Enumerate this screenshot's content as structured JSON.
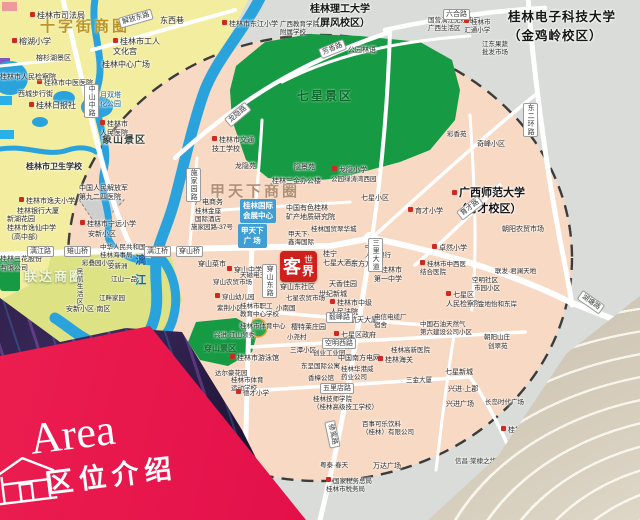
{
  "banner": {
    "title_en": "Area",
    "title_zh": "区位介绍"
  },
  "logo": {
    "c1": "客",
    "c2": "世",
    "c3": "界",
    "name": "客世界"
  },
  "palette": {
    "banner_red": "#e3114a",
    "logo_red": "#d0201c",
    "circle_fill": "#f8d9c3",
    "outside_gray": "#d9dcd8",
    "old_town_yellow": "#f3eda0",
    "park_green": "#169a43",
    "water_blue": "#2aa3dc",
    "road_white": "#ffffff",
    "dash_border": "#3c3c3c"
  },
  "map": {
    "labels": [
      {
        "t": "十字街商圈",
        "x": 40,
        "y": 18,
        "c": "biz1"
      },
      {
        "t": "甲天下商圈",
        "x": 210,
        "y": 183,
        "c": "biz2"
      },
      {
        "t": "联达商圈",
        "x": 24,
        "y": 269,
        "c": "biz3"
      },
      {
        "t": "七星景区",
        "x": 297,
        "y": 89,
        "c": "grn grnb"
      },
      {
        "t": "象山景区",
        "x": 102,
        "y": 135,
        "c": "dkb"
      },
      {
        "t": "穿山景区",
        "x": 204,
        "y": 344,
        "c": "grn"
      },
      {
        "t": "漓江",
        "x": 132,
        "y": 254,
        "c": "wtrv"
      },
      {
        "t": "桂林电子科技大学\n（金鸡岭校区）",
        "x": 508,
        "y": 8,
        "c": "uni"
      },
      {
        "t": "广西师范大学\n（育才校区）",
        "x": 452,
        "y": 186,
        "c": "uni2 cen",
        "ic": true
      },
      {
        "t": "桂林理工大学\n（屏风校区）",
        "x": 310,
        "y": 3,
        "c": "uni3 cen"
      },
      {
        "t": "桂林市司法局",
        "x": 30,
        "y": 11,
        "ic": true
      },
      {
        "t": "东西巷",
        "x": 160,
        "y": 16
      },
      {
        "t": "桂林市工人\n文化宫",
        "x": 113,
        "y": 37,
        "ic": true
      },
      {
        "t": "桂林中心广场",
        "x": 102,
        "y": 60
      },
      {
        "t": "榕湖小学",
        "x": 12,
        "y": 37,
        "ic": true
      },
      {
        "t": "榕杉湖景区",
        "x": 36,
        "y": 55,
        "c": "t7"
      },
      {
        "t": "桂林市中医医院",
        "x": 37,
        "y": 79,
        "c": "t7",
        "ic": true
      },
      {
        "t": "西城步行街",
        "x": 18,
        "y": 91,
        "c": "t7"
      },
      {
        "t": "桂林日报社",
        "x": 29,
        "y": 101,
        "ic": true
      },
      {
        "t": "日月双塔\n文化公园",
        "x": 93,
        "y": 92,
        "c": "wtr t7"
      },
      {
        "t": "桂林市人民检察院",
        "x": 0,
        "y": 74,
        "c": "t7"
      },
      {
        "t": "桂林市\n人民医院",
        "x": 100,
        "y": 120,
        "c": "t7",
        "ic": true
      },
      {
        "t": "桂林市卫生学校",
        "x": 26,
        "y": 162,
        "c": "bold"
      },
      {
        "t": "桂林市逸夫小学",
        "x": 19,
        "y": 197,
        "c": "t7",
        "ic": true
      },
      {
        "t": "桂林银行大厦",
        "x": 17,
        "y": 208,
        "c": "t7"
      },
      {
        "t": "新湖花园",
        "x": 7,
        "y": 216,
        "c": "t7"
      },
      {
        "t": "桂林市逸仙中学\n（高中部）",
        "x": 7,
        "y": 225,
        "c": "t7"
      },
      {
        "t": "桂林三花股份\n有限公司",
        "x": 0,
        "y": 256,
        "c": "t7"
      },
      {
        "t": "中国人民解放军\n第九二四医院",
        "x": 79,
        "y": 185,
        "c": "t7"
      },
      {
        "t": "桂林市宁远小学",
        "x": 80,
        "y": 220,
        "c": "t7",
        "ic": true
      },
      {
        "t": "安新小区",
        "x": 88,
        "y": 231,
        "c": "t7"
      },
      {
        "t": "彩叠园小区",
        "x": 82,
        "y": 260,
        "c": "t65"
      },
      {
        "t": "民航生活区",
        "x": 74,
        "y": 268,
        "c": "t65 vert"
      },
      {
        "t": "安新洲",
        "x": 108,
        "y": 263,
        "c": "t65"
      },
      {
        "t": "江山一品",
        "x": 111,
        "y": 276,
        "c": "t65"
      },
      {
        "t": "江畔家园",
        "x": 99,
        "y": 295,
        "c": "t65"
      },
      {
        "t": "安新小区·南区",
        "x": 66,
        "y": 306,
        "c": "t7"
      },
      {
        "t": "中华人民共和国\n桂林海事局",
        "x": 100,
        "y": 244,
        "c": "t65"
      },
      {
        "t": "漓江路",
        "x": 27,
        "y": 246,
        "c": "rbox"
      },
      {
        "t": "雉山桥",
        "x": 64,
        "y": 246,
        "c": "rbox"
      },
      {
        "t": "漓江桥",
        "x": 144,
        "y": 246,
        "c": "rbox"
      },
      {
        "t": "穿山桥",
        "x": 176,
        "y": 246,
        "c": "rbox"
      },
      {
        "t": "解放东路",
        "x": 118,
        "y": 18,
        "c": "rbox",
        "rot": -16
      },
      {
        "t": "中山中路",
        "x": 84,
        "y": 84,
        "c": "rbox vert"
      },
      {
        "t": "桂林市东江小学",
        "x": 222,
        "y": 20,
        "c": "t7",
        "ic": true
      },
      {
        "t": "广西教育学院\n附属学校",
        "x": 280,
        "y": 21,
        "c": "t65"
      },
      {
        "t": "公园林语",
        "x": 348,
        "y": 47,
        "c": "t7"
      },
      {
        "t": "桂林市交通\n技工学校",
        "x": 212,
        "y": 136,
        "c": "t7",
        "ic": true
      },
      {
        "t": "龙隐苑",
        "x": 235,
        "y": 163,
        "c": "t7"
      },
      {
        "t": "隐景苑",
        "x": 294,
        "y": 164,
        "c": "t7"
      },
      {
        "t": "龙隐小学",
        "x": 332,
        "y": 166,
        "c": "t7",
        "ic": true
      },
      {
        "t": "公园绿涛湾西园",
        "x": 331,
        "y": 176,
        "c": "t65"
      },
      {
        "t": "桂林三金办公楼",
        "x": 272,
        "y": 178,
        "c": "t7"
      },
      {
        "t": "七星小区",
        "x": 361,
        "y": 195,
        "c": "t7"
      },
      {
        "t": "广电商务",
        "x": 195,
        "y": 199,
        "c": "t7"
      },
      {
        "t": "桂林金座\n国际酒店",
        "x": 195,
        "y": 208,
        "c": "t65"
      },
      {
        "t": "施家园路-37号",
        "x": 191,
        "y": 224,
        "c": "t65"
      },
      {
        "t": "中国有色桂林\n矿产地质研究院",
        "x": 286,
        "y": 205,
        "c": "t7"
      },
      {
        "t": "桂林国贸翠华城",
        "x": 311,
        "y": 226,
        "c": "t65"
      },
      {
        "t": "甲天下·\n鑫海国际",
        "x": 288,
        "y": 231,
        "c": "t65"
      },
      {
        "t": "桂宁\n七星大酒店",
        "x": 323,
        "y": 251,
        "c": "t7"
      },
      {
        "t": "中国\n人民银行",
        "x": 365,
        "y": 244,
        "c": "t65"
      },
      {
        "t": "东方方圆",
        "x": 351,
        "y": 261,
        "c": "t7"
      },
      {
        "t": "天香佳园",
        "x": 329,
        "y": 281,
        "c": "t7"
      },
      {
        "t": "世纪新城",
        "x": 319,
        "y": 291,
        "c": "t7"
      },
      {
        "t": "桂林市中级\n人民法院",
        "x": 330,
        "y": 299,
        "c": "t7",
        "ic": true
      },
      {
        "t": "桂林市\n第一中学",
        "x": 374,
        "y": 266,
        "c": "t7",
        "ic": true
      },
      {
        "t": "奇峰小区",
        "x": 477,
        "y": 141,
        "c": "t7"
      },
      {
        "t": "彩香苑",
        "x": 447,
        "y": 131,
        "c": "t65"
      },
      {
        "t": "国营漓江无线电厂\n广西生活区",
        "x": 428,
        "y": 17,
        "c": "t65"
      },
      {
        "t": "桂林市\n汇通小学",
        "x": 464,
        "y": 18,
        "c": "t65 cen",
        "ic": true
      },
      {
        "t": "江东果蔬\n批发市场",
        "x": 482,
        "y": 41,
        "c": "t65"
      },
      {
        "t": "六合路",
        "x": 443,
        "y": 9,
        "c": "rbox"
      },
      {
        "t": "芳香路",
        "x": 318,
        "y": 49,
        "c": "rbox",
        "rot": -22
      },
      {
        "t": "龙隐路",
        "x": 224,
        "y": 119,
        "c": "rbox",
        "rot": -40
      },
      {
        "t": "施家园路",
        "x": 186,
        "y": 168,
        "c": "rbox vert"
      },
      {
        "t": "东二环路",
        "x": 523,
        "y": 103,
        "c": "rbox vert"
      },
      {
        "t": "育才路",
        "x": 456,
        "y": 212,
        "c": "rbox",
        "rot": -38
      },
      {
        "t": "湖塘路",
        "x": 583,
        "y": 290,
        "c": "rbox",
        "rot": 35
      },
      {
        "t": "三里大道",
        "x": 368,
        "y": 238,
        "c": "rbox vert"
      },
      {
        "t": "育才小学",
        "x": 408,
        "y": 207,
        "c": "t7",
        "ic": true
      },
      {
        "t": "朝阳农贸市场",
        "x": 502,
        "y": 226,
        "c": "t7"
      },
      {
        "t": "卓然小学",
        "x": 432,
        "y": 244,
        "c": "t7",
        "ic": true
      },
      {
        "t": "桂林市中西医\n结合医院",
        "x": 420,
        "y": 260,
        "c": "t65",
        "ic": true
      },
      {
        "t": "联发·君澜天地",
        "x": 495,
        "y": 268,
        "c": "t65"
      },
      {
        "t": "空明社区",
        "x": 472,
        "y": 277,
        "c": "t65"
      },
      {
        "t": "市园小区",
        "x": 474,
        "y": 285,
        "c": "t65"
      },
      {
        "t": "七星区\n人民检察院",
        "x": 446,
        "y": 291,
        "c": "t7",
        "ic": true
      },
      {
        "t": "金地怡和东岸",
        "x": 478,
        "y": 301,
        "c": "t65"
      },
      {
        "t": "穿山菜市",
        "x": 198,
        "y": 261,
        "c": "t7"
      },
      {
        "t": "穿山中学",
        "x": 227,
        "y": 266,
        "c": "t7",
        "ic": true
      },
      {
        "t": "穿山农贸市场",
        "x": 213,
        "y": 279,
        "c": "t65"
      },
      {
        "t": "天磁电三厂",
        "x": 240,
        "y": 272,
        "c": "t65"
      },
      {
        "t": "穿山幼儿园",
        "x": 215,
        "y": 293,
        "c": "t65",
        "ic": true
      },
      {
        "t": "紫荆小区",
        "x": 217,
        "y": 305,
        "c": "t65"
      },
      {
        "t": "桂林市职工\n教育中心学校",
        "x": 240,
        "y": 303,
        "c": "t65"
      },
      {
        "t": "兴进·江山领秀",
        "x": 214,
        "y": 332,
        "c": "t65"
      },
      {
        "t": "穿山东社区",
        "x": 280,
        "y": 284,
        "c": "t7"
      },
      {
        "t": "七星农贸市场",
        "x": 286,
        "y": 295,
        "c": "t65"
      },
      {
        "t": "小南国",
        "x": 276,
        "y": 305,
        "c": "t65"
      },
      {
        "t": "小尧村",
        "x": 287,
        "y": 334,
        "c": "t65"
      },
      {
        "t": "穿山东路",
        "x": 262,
        "y": 264,
        "c": "rbox vert"
      },
      {
        "t": "樱特莱庄园",
        "x": 291,
        "y": 324,
        "c": "t7"
      },
      {
        "t": "航天大厦",
        "x": 350,
        "y": 317,
        "c": "t7"
      },
      {
        "t": "七星区政府",
        "x": 334,
        "y": 331,
        "c": "t7",
        "ic": true
      },
      {
        "t": "电信电缆厂\n宿舍",
        "x": 374,
        "y": 314,
        "c": "t65"
      },
      {
        "t": "毅峰路",
        "x": 326,
        "y": 312,
        "c": "rbox"
      },
      {
        "t": "空明西路",
        "x": 322,
        "y": 338,
        "c": "rbox"
      },
      {
        "t": "五里店路",
        "x": 320,
        "y": 383,
        "c": "rbox"
      },
      {
        "t": "骖鸾路",
        "x": 335,
        "y": 420,
        "c": "rbox",
        "rot": 78
      },
      {
        "t": "桂林市体育中心",
        "x": 240,
        "y": 323,
        "c": "t65"
      },
      {
        "t": "桂林市游泳馆",
        "x": 230,
        "y": 354,
        "c": "t7",
        "ic": true
      },
      {
        "t": "达尔豪花园",
        "x": 215,
        "y": 370,
        "c": "t65"
      },
      {
        "t": "桂林市体育\n运动学校",
        "x": 231,
        "y": 377,
        "c": "t65"
      },
      {
        "t": "德才小学",
        "x": 236,
        "y": 389,
        "c": "t65",
        "ic": true
      },
      {
        "t": "三潭小区",
        "x": 290,
        "y": 347,
        "c": "t65"
      },
      {
        "t": "创业工业园",
        "x": 313,
        "y": 350,
        "c": "t65"
      },
      {
        "t": "中国南方电网",
        "x": 338,
        "y": 355,
        "c": "t7"
      },
      {
        "t": "桂林海关",
        "x": 378,
        "y": 356,
        "c": "t7",
        "ic": true
      },
      {
        "t": "东呈国际公寓",
        "x": 301,
        "y": 363,
        "c": "t65"
      },
      {
        "t": "香樟公馆",
        "x": 308,
        "y": 375,
        "c": "t65"
      },
      {
        "t": "桂林华港威\n药业公司",
        "x": 341,
        "y": 366,
        "c": "t65"
      },
      {
        "t": "桂林技师学院\n（桂林高级技工学校）",
        "x": 313,
        "y": 396,
        "c": "t65"
      },
      {
        "t": "百事可乐饮料\n（桂林）有限公司",
        "x": 362,
        "y": 421,
        "c": "t65"
      },
      {
        "t": "粤泰·春天",
        "x": 320,
        "y": 462,
        "c": "t65"
      },
      {
        "t": "万达广场",
        "x": 373,
        "y": 463,
        "c": "t7"
      },
      {
        "t": "国家税务总局\n桂林市税务局",
        "x": 326,
        "y": 477,
        "c": "t65",
        "ic": true
      },
      {
        "t": "桂林高新医院",
        "x": 391,
        "y": 347,
        "c": "t65"
      },
      {
        "t": "三金大厦",
        "x": 406,
        "y": 377,
        "c": "t65"
      },
      {
        "t": "中国石油天然气\n第六建设公司小区",
        "x": 420,
        "y": 321,
        "c": "t65"
      },
      {
        "t": "朝阳山庄",
        "x": 484,
        "y": 334,
        "c": "t65"
      },
      {
        "t": "创翠苑",
        "x": 488,
        "y": 343,
        "c": "t65"
      },
      {
        "t": "七星新城",
        "x": 445,
        "y": 369,
        "c": "t7"
      },
      {
        "t": "兴进·上郡",
        "x": 448,
        "y": 386,
        "c": "t7"
      },
      {
        "t": "兴进广场",
        "x": 446,
        "y": 401,
        "c": "t7"
      },
      {
        "t": "长岛时代广场",
        "x": 485,
        "y": 399,
        "c": "t65"
      },
      {
        "t": "桂林任远中学",
        "x": 501,
        "y": 426,
        "c": "t7",
        "ic": true
      },
      {
        "t": "信昌·棠棣之华",
        "x": 455,
        "y": 458,
        "c": "t65"
      }
    ],
    "boxes": [
      {
        "t": "桂林国际\n会展中心",
        "x": 240,
        "y": 199
      },
      {
        "t": "甲天下\n广 场",
        "x": 238,
        "y": 224
      }
    ]
  }
}
